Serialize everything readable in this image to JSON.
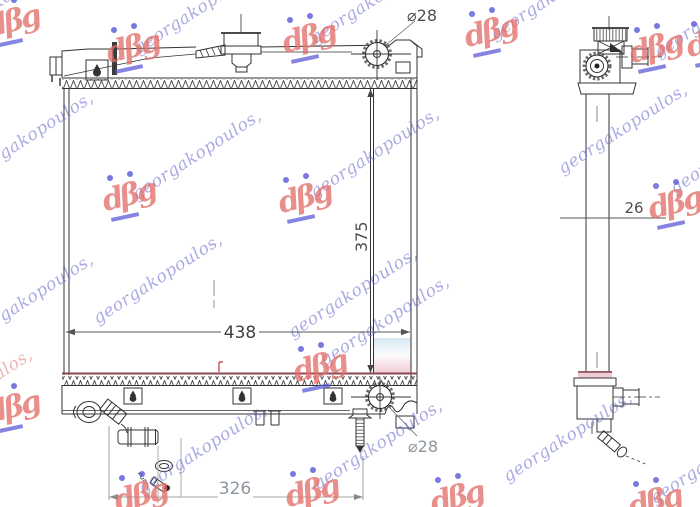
{
  "drawing": {
    "type": "radiator-technical-drawing",
    "dimensions": {
      "top_inlet_diameter": "⌀28",
      "bottom_outlet_diameter": "⌀28",
      "core_height": "375",
      "core_width": "438",
      "mounting_span": "326",
      "core_thickness": "26"
    },
    "colors": {
      "line": "#333333",
      "dim_text": "#4f4f4f",
      "dim_text_light": "#8e959d",
      "core_bottom_line": "#8a4a52",
      "end_tank_pink": "#f0cdd5",
      "end_tank_blue": "#d8e7f2"
    }
  },
  "watermark": {
    "text": "georgakopoulos,",
    "monogram_glyph": "dβg",
    "blue": "#6464d2",
    "red": "#e27676"
  }
}
